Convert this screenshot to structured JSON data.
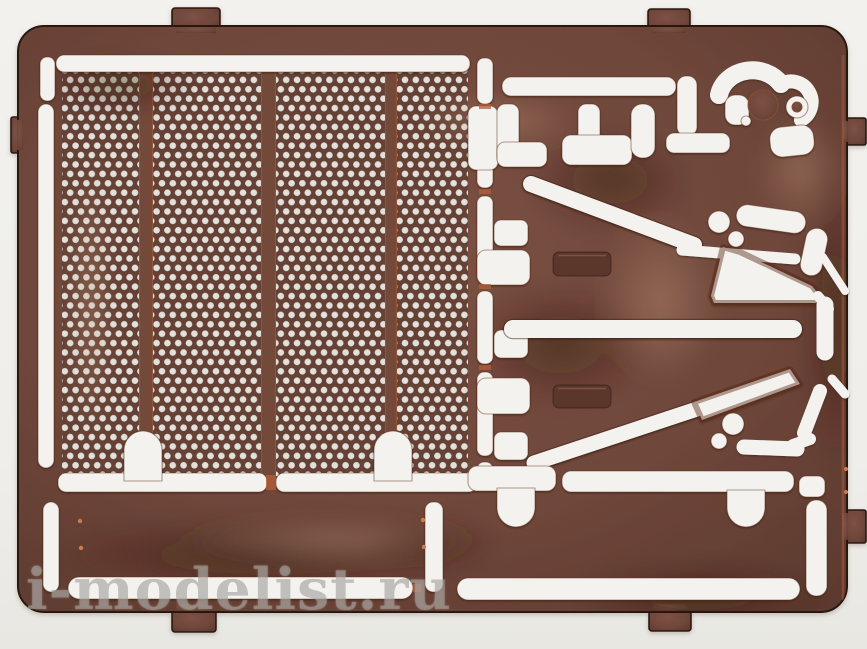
{
  "photo": {
    "watermark": "i-modelist.ru",
    "palette": {
      "background": "#f0efeb",
      "copper_base": "#6f463a",
      "copper_dark": "#54332a",
      "copper_light": "#8d6150",
      "bare_copper_edge": "#c4693f",
      "cutout_white": "#f3f2ee",
      "watermark_gray": "#9e9b96"
    }
  }
}
